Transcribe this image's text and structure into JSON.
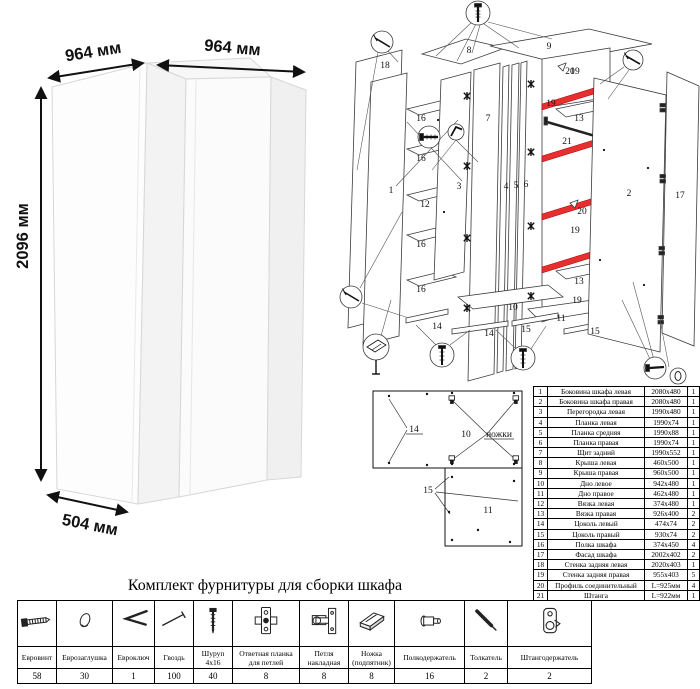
{
  "dimensions": {
    "width_left": "964 мм",
    "width_right": "964 мм",
    "height": "2096 мм",
    "depth": "504 мм"
  },
  "diagram": {
    "num": {
      "1": "1",
      "2": "2",
      "3": "3",
      "4": "4",
      "5": "5",
      "6": "6",
      "7": "7",
      "8": "8",
      "9": "9",
      "10": "10",
      "11": "11",
      "12": "12",
      "13": "13",
      "14": "14",
      "15": "15",
      "16": "16",
      "17": "17",
      "18": "18",
      "19": "19",
      "20": "20",
      "21": "21"
    },
    "legs_label": "ножки"
  },
  "parts_table": {
    "rows": [
      {
        "num": "1",
        "name": "Боковина шкафа левая",
        "size": "2080x480",
        "qty": "1"
      },
      {
        "num": "2",
        "name": "Боковина шкафа правая",
        "size": "2080x480",
        "qty": "1"
      },
      {
        "num": "3",
        "name": "Перегородка левая",
        "size": "1990x480",
        "qty": "1"
      },
      {
        "num": "4",
        "name": "Планка левая",
        "size": "1990x74",
        "qty": "1"
      },
      {
        "num": "5",
        "name": "Планка средняя",
        "size": "1990x88",
        "qty": "1"
      },
      {
        "num": "6",
        "name": "Планка правая",
        "size": "1990x74",
        "qty": "1"
      },
      {
        "num": "7",
        "name": "Щит задний",
        "size": "1990x552",
        "qty": "1"
      },
      {
        "num": "8",
        "name": "Крыша левая",
        "size": "460x500",
        "qty": "1"
      },
      {
        "num": "9",
        "name": "Крыша правая",
        "size": "960x500",
        "qty": "1"
      },
      {
        "num": "10",
        "name": "Дно левое",
        "size": "942x480",
        "qty": "1"
      },
      {
        "num": "11",
        "name": "Дно правое",
        "size": "462x480",
        "qty": "1"
      },
      {
        "num": "12",
        "name": "Вязка левая",
        "size": "374x480",
        "qty": "1"
      },
      {
        "num": "13",
        "name": "Вязка правая",
        "size": "926x400",
        "qty": "2"
      },
      {
        "num": "14",
        "name": "Цоколь левый",
        "size": "474x74",
        "qty": "2"
      },
      {
        "num": "15",
        "name": "Цоколь правый",
        "size": "930x74",
        "qty": "2"
      },
      {
        "num": "16",
        "name": "Полка шкафа",
        "size": "374x450",
        "qty": "4"
      },
      {
        "num": "17",
        "name": "Фасад шкафа",
        "size": "2002x402",
        "qty": "2"
      },
      {
        "num": "18",
        "name": "Стенка задняя левая",
        "size": "2020x403",
        "qty": "1"
      },
      {
        "num": "19",
        "name": "Стенка задняя правая",
        "size": "955x403",
        "qty": "5"
      },
      {
        "num": "20",
        "name": "Профиль соединительный",
        "size": "L=925мм",
        "qty": "4"
      },
      {
        "num": "21",
        "name": "Штанга",
        "size": "L=922мм",
        "qty": "1"
      }
    ]
  },
  "hardware": {
    "title": "Комплект фурнитуры для сборки шкафа",
    "items": [
      {
        "icon": "eurovint-icon",
        "name": "Евровинт",
        "qty": "58"
      },
      {
        "icon": "europlug-icon",
        "name": "Еврозаглушка",
        "qty": "30"
      },
      {
        "icon": "eurokey-icon",
        "name": "Евроключ",
        "qty": "1"
      },
      {
        "icon": "nail-icon",
        "name": "Гвоздь",
        "qty": "100"
      },
      {
        "icon": "screw-icon",
        "name": "Шуруп 4x16",
        "qty": "40"
      },
      {
        "icon": "hinge-plate-icon",
        "name": "Ответная планка для петлей",
        "qty": "8"
      },
      {
        "icon": "hinge-icon",
        "name": "Петля накладная",
        "qty": "8"
      },
      {
        "icon": "foot-icon",
        "name": "Ножка (подпятник)",
        "qty": "8"
      },
      {
        "icon": "shelf-holder-icon",
        "name": "Полкодержатель",
        "qty": "16"
      },
      {
        "icon": "pusher-icon",
        "name": "Толкатель",
        "qty": "2"
      },
      {
        "icon": "rod-holder-icon",
        "name": "Штангодержатель",
        "qty": "2"
      }
    ]
  },
  "colors": {
    "profile_red": "#e82f2f",
    "profile_red_light": "#ff8d8d"
  }
}
